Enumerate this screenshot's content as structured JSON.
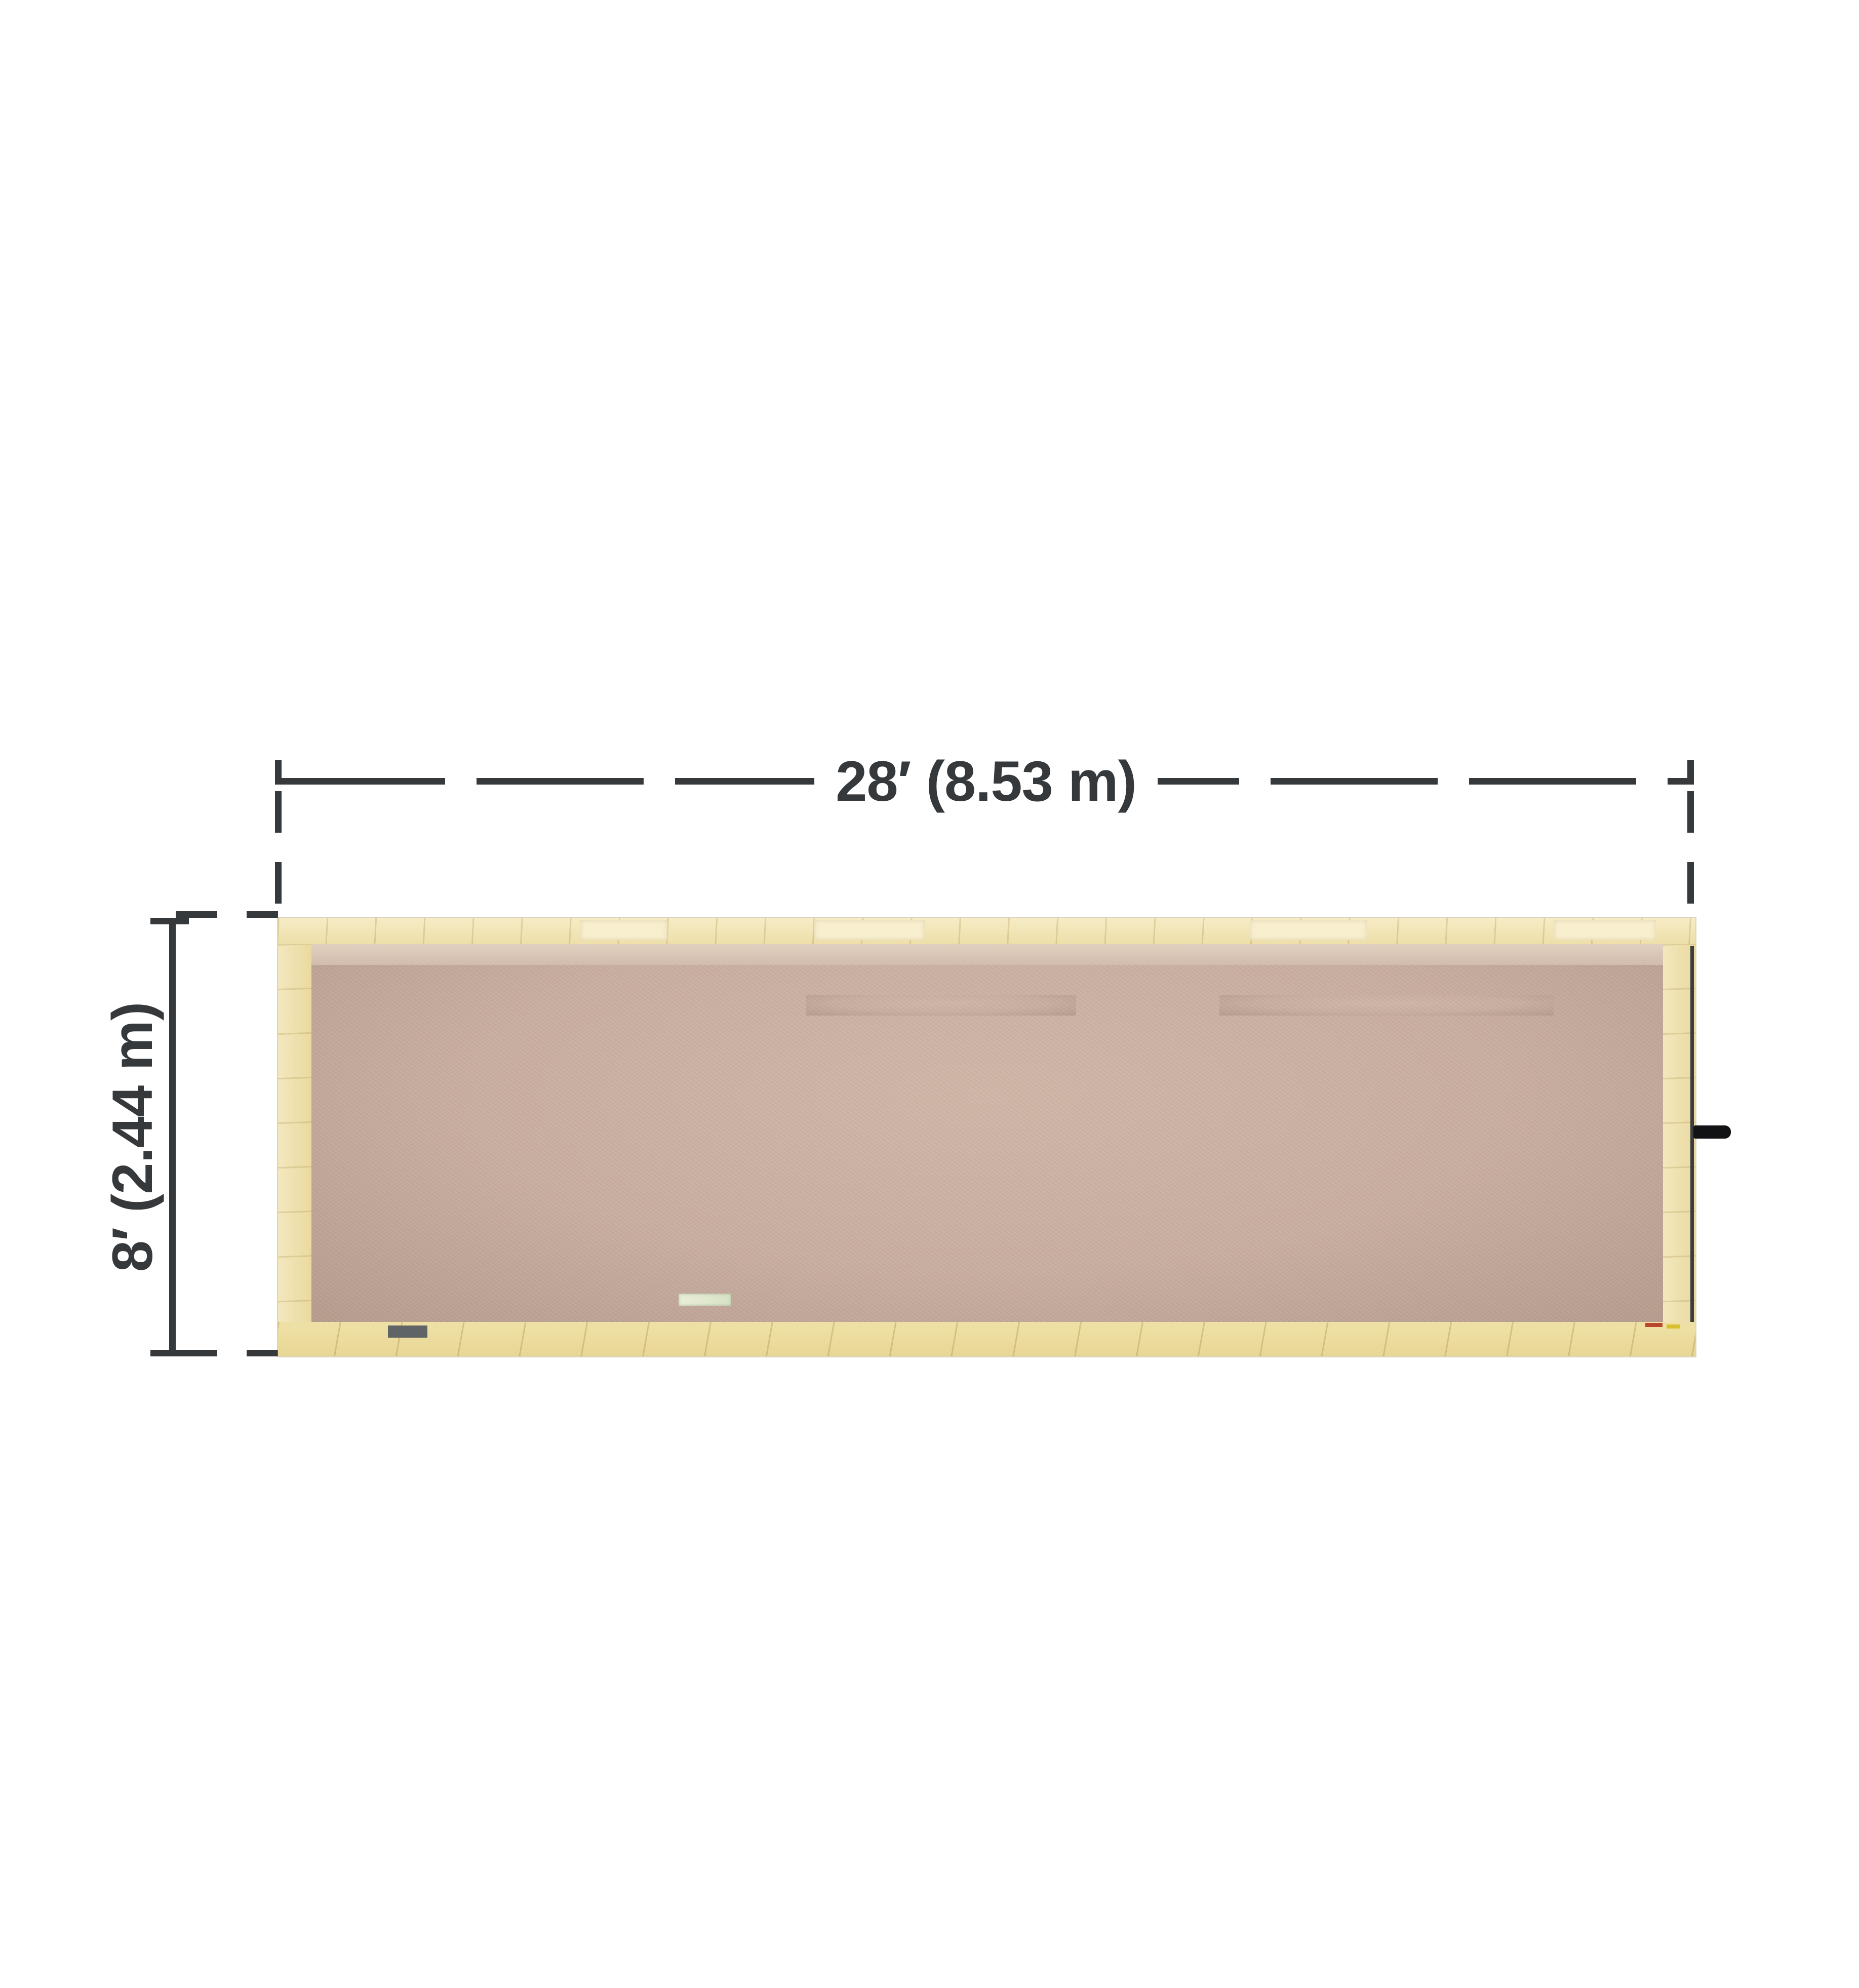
{
  "scene": {
    "type": "3d-floor-plan-top-view",
    "subject": "28 ft restroom trailer with two restrooms",
    "background_color": "#ffffff"
  },
  "dimensions": {
    "width_label": "28′ (8.53 m)",
    "depth_label": "8′ (2.44 m)"
  },
  "building": {
    "left_room": {
      "name": "left restroom",
      "fixtures": {
        "urinals": 3,
        "urinal_privacy_shelves": 2,
        "wall_sinks": 2,
        "mirrors": 2,
        "paper_towel_dispensers": 1,
        "toilet_stalls": 2,
        "toilets": 2,
        "toilet_paper_dispensers": 2,
        "ceiling_vents": 1,
        "floor_drains": 1,
        "entry_doors": 1,
        "threshold_mats": 1,
        "exterior_steps": 1
      }
    },
    "right_room": {
      "name": "right restroom",
      "fixtures": {
        "wall_sinks": 1,
        "mirrors": 1,
        "paper_towel_dispensers": 1,
        "soap_dispensers": 1,
        "toilet_stalls": 3,
        "toilets": 3,
        "toilet_paper_dispensers": 3,
        "wall_fans": 1,
        "floor_drains": 1,
        "entry_doors": 1,
        "threshold_mats": 1,
        "end_door_handles": 1
      }
    },
    "transom_windows": 4,
    "center_partition_walls": 1
  },
  "palette": {
    "dimension_text": "#35393c",
    "wall_cream": "#f1e4b8",
    "deck_wood": "#ecdda2",
    "floor_tan": "#c8aea0",
    "mat_gray": "#9fa6ab",
    "partition_white": "#e6e5ee",
    "divider_slate": "#74checked",
    "divider_slate_top": "#8da0ac",
    "divider_slate_bottom": "#5f7280",
    "fixture_white": "#f7f7f9",
    "chrome": "#aeb6bd",
    "drain_black": "#1d1f20",
    "step_wood": "#dfc08d",
    "threshold_pink": "#c3a59d",
    "door_pale": "#e6e8dc"
  }
}
